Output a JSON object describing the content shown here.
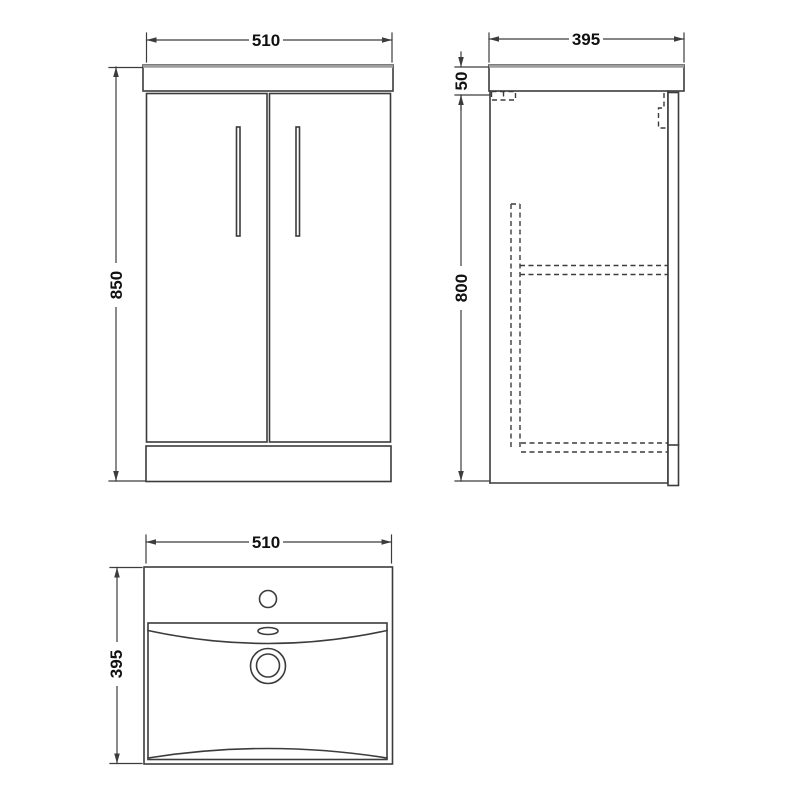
{
  "colors": {
    "background": "#ffffff",
    "line": "#3c3c3c",
    "counter_top_edge": "#9e9e9e",
    "dimension_text": "#111111"
  },
  "views": {
    "front": {
      "width_dim": "510",
      "height_dim": "850"
    },
    "side": {
      "depth_dim": "395",
      "counter_height_dim": "50",
      "cabinet_height_dim": "800"
    },
    "plan": {
      "width_dim": "510",
      "depth_dim": "395"
    }
  }
}
